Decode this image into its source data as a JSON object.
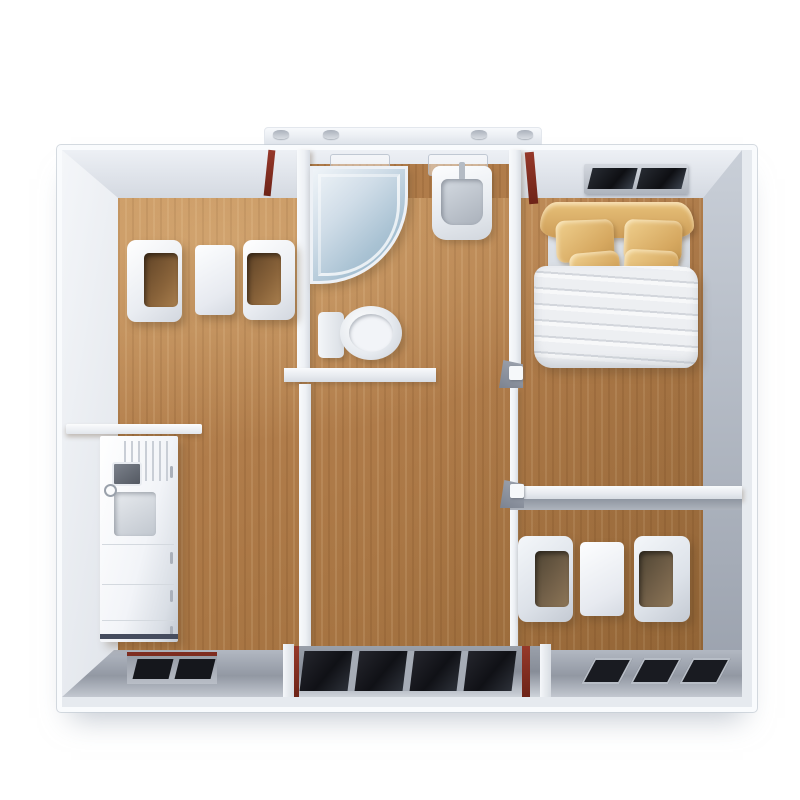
{
  "scene": {
    "subject": "prefab-container-home-floor-plan",
    "view": "top-down-3d-render",
    "background_color": "#ffffff"
  },
  "colors": {
    "background": "#ffffff",
    "wood": "#b07c4a",
    "wood_light": "#c4915c",
    "wood_dark": "#a06f3d",
    "wall_white": "#f6f8fa",
    "wall_light": "#e9edf2",
    "wall_mid": "#c6ccd5",
    "wall_dark": "#99a0ac",
    "band_gray": "#9aa0ab",
    "window_dark": "#17181d",
    "accent_red": "#7e2d20",
    "tan": "#e7c179",
    "duvet": "#edeff2",
    "glass_blue": "#a9c2d3"
  },
  "rooms": {
    "living_area": {
      "items": [
        "armchair",
        "coffee-table",
        "armchair",
        "kitchenette-counter",
        "kitchen-sink",
        "hob"
      ]
    },
    "bathroom": {
      "items": [
        "corner-glass-shower",
        "wall-basin",
        "toilet"
      ]
    },
    "bedroom": {
      "items": [
        "wall-window",
        "curved-headboard",
        "double-bed",
        "four-tan-pillows",
        "white-duvet"
      ]
    },
    "second_seating_area": {
      "items": [
        "armchair",
        "side-table",
        "armchair"
      ]
    },
    "entrance": {
      "items": [
        "glazed-entry-doors",
        "left-window",
        "right-window-strip"
      ]
    }
  }
}
